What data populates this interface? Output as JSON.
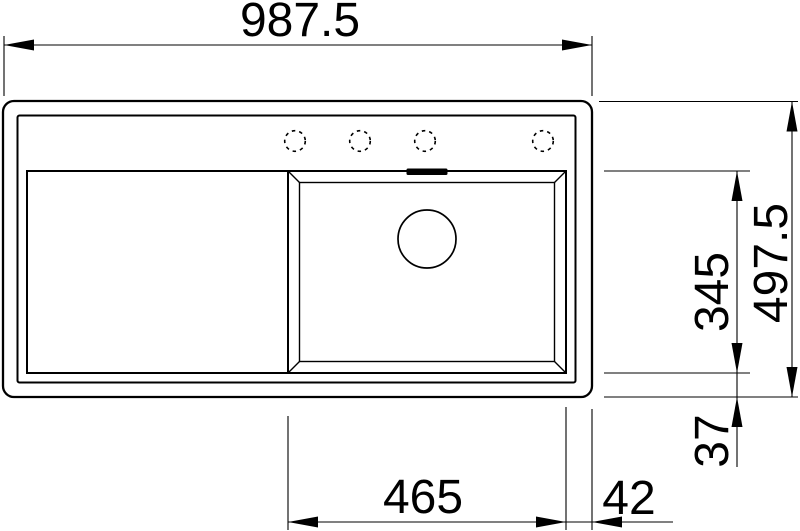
{
  "drawing": {
    "type": "sink-installation-top-view",
    "colors": {
      "line": "#000000",
      "background": "#ffffff"
    },
    "features": {
      "tap_holes": 4,
      "bowl": "right",
      "drainboard": "left"
    }
  },
  "dimensions": {
    "overall_width": "987.5",
    "overall_depth": "497.5",
    "bowl_depth": "345",
    "bowl_bottom_offset": "37",
    "bowl_width": "465",
    "bowl_right_offset": "42"
  }
}
